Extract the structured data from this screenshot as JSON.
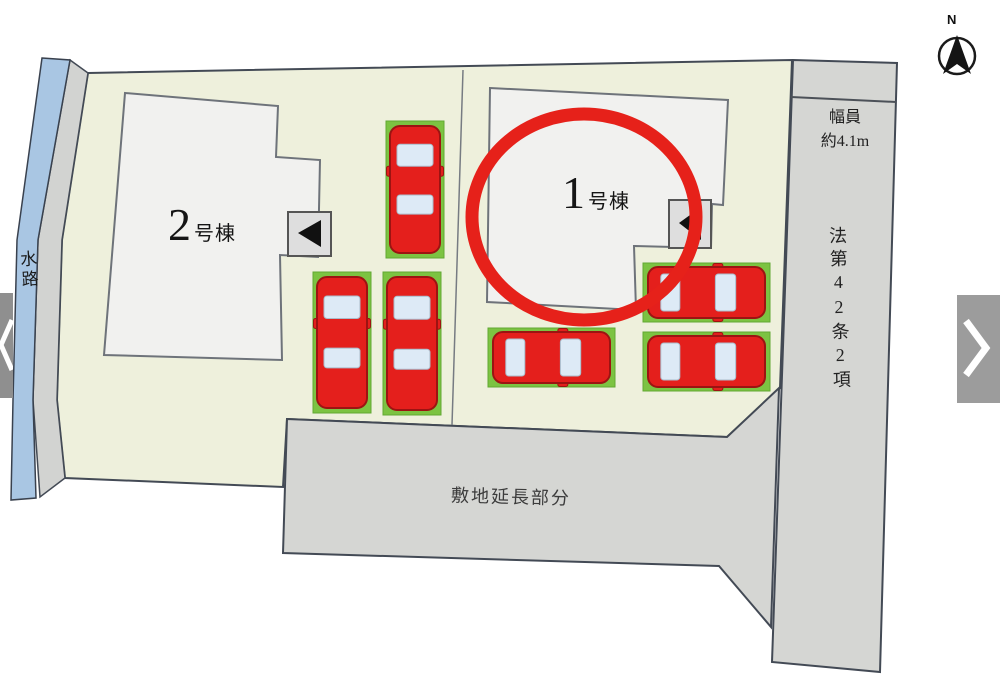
{
  "viewer": {
    "prev_button": {
      "icon": "chevron-left"
    },
    "next_button": {
      "icon": "chevron-right"
    }
  },
  "compass": {
    "north_label": "N"
  },
  "site_plan": {
    "buildings": [
      {
        "name": "2号棟",
        "number": "2",
        "suffix": "号棟",
        "highlighted": false
      },
      {
        "name": "1号棟",
        "number": "1",
        "suffix": "号棟",
        "highlighted": true
      }
    ],
    "waterway_label": "水路",
    "extension_label": "敷地延長部分",
    "road": {
      "width_label_line1": "幅員",
      "width_label_line2": "約4.1m",
      "regulation_label": "法第42条2項"
    },
    "colors": {
      "site_green": "#eef0dc",
      "waterway_blue": "#a9c6e3",
      "road_gray": "#d5d6d3",
      "left_strip_gray": "#d2d3d1",
      "building_white": "#f1f1ef",
      "marker_gray": "#dedede",
      "highlight_red": "#e6211a",
      "car_red": "#e41f1c",
      "car_outline": "#9c1412",
      "car_window": "#ddeaf6",
      "parking_pad_green": "#7cc342"
    },
    "parking_spots": [
      {
        "x": 386,
        "y": 121,
        "w": 58,
        "h": 137,
        "dir": "v"
      },
      {
        "x": 313,
        "y": 272,
        "w": 58,
        "h": 141,
        "dir": "v"
      },
      {
        "x": 383,
        "y": 272,
        "w": 58,
        "h": 143,
        "dir": "v"
      },
      {
        "x": 643,
        "y": 263,
        "w": 127,
        "h": 59,
        "dir": "h"
      },
      {
        "x": 488,
        "y": 328,
        "w": 127,
        "h": 59,
        "dir": "h"
      },
      {
        "x": 643,
        "y": 332,
        "w": 127,
        "h": 59,
        "dir": "h"
      }
    ]
  }
}
